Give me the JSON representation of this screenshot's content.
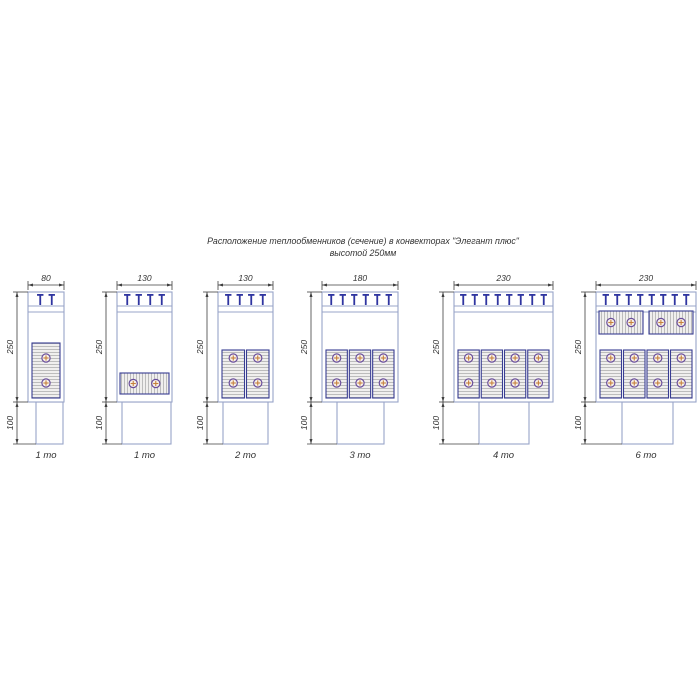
{
  "title": {
    "line1": "Расположение теплообменников (сечение) в конвекторах \"Элегант плюс\"",
    "line2": "высотой 250мм"
  },
  "colors": {
    "outline": "#98a4c8",
    "clip": "#2e34a0",
    "exchanger_border": "#383c92",
    "hatch_line": "#a6a6a6",
    "hatch_bg": "#f0efee",
    "tube_ring": "#6a4e9b",
    "tube_fill": "#f7f1e9",
    "tube_cross": "#c6803c",
    "dimension": "#3f3f3f",
    "text": "#333333"
  },
  "diagrams": [
    {
      "label": "1 то",
      "width_mm": "80",
      "height_mm": "250",
      "duct_mm": "100",
      "clips": 2,
      "body": {
        "x": 28,
        "w": 36
      },
      "duct": {
        "x": 36,
        "w": 27
      },
      "exchangers": {
        "vertical_columns": 1,
        "wide_horizontal": 0,
        "top_horizontal": 0
      }
    },
    {
      "label": "1 то",
      "width_mm": "130",
      "height_mm": "250",
      "duct_mm": "100",
      "clips": 4,
      "body": {
        "x": 117,
        "w": 55
      },
      "duct": {
        "x": 122,
        "w": 49
      },
      "exchangers": {
        "vertical_columns": 0,
        "wide_horizontal": 1,
        "top_horizontal": 0
      }
    },
    {
      "label": "2 то",
      "width_mm": "130",
      "height_mm": "250",
      "duct_mm": "100",
      "clips": 4,
      "body": {
        "x": 218,
        "w": 55
      },
      "duct": {
        "x": 223,
        "w": 45
      },
      "exchangers": {
        "vertical_columns": 2,
        "wide_horizontal": 0,
        "top_horizontal": 0
      }
    },
    {
      "label": "3 то",
      "width_mm": "180",
      "height_mm": "250",
      "duct_mm": "100",
      "clips": 6,
      "body": {
        "x": 322,
        "w": 76
      },
      "duct": {
        "x": 337,
        "w": 47
      },
      "exchangers": {
        "vertical_columns": 3,
        "wide_horizontal": 0,
        "top_horizontal": 0
      }
    },
    {
      "label": "4 то",
      "width_mm": "230",
      "height_mm": "250",
      "duct_mm": "100",
      "clips": 8,
      "body": {
        "x": 454,
        "w": 99
      },
      "duct": {
        "x": 479,
        "w": 50
      },
      "exchangers": {
        "vertical_columns": 4,
        "wide_horizontal": 0,
        "top_horizontal": 0
      }
    },
    {
      "label": "6 то",
      "width_mm": "230",
      "height_mm": "250",
      "duct_mm": "100",
      "clips": 8,
      "body": {
        "x": 596,
        "w": 100
      },
      "duct": {
        "x": 622,
        "w": 51
      },
      "exchangers": {
        "vertical_columns": 4,
        "wide_horizontal": 0,
        "top_horizontal": 2
      }
    }
  ]
}
